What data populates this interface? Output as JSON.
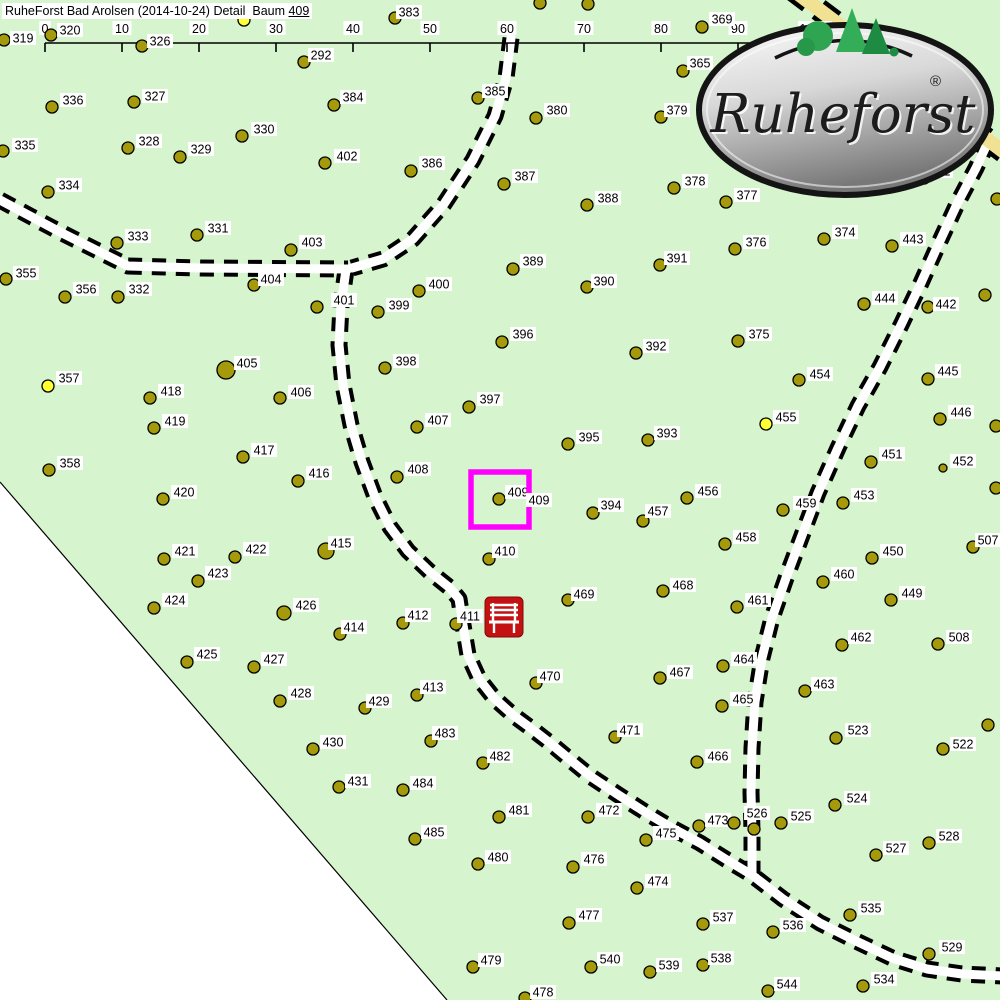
{
  "title": {
    "main": "RuheForst Bad Arolsen (2014-10-24) Detail  Baum ",
    "highlight": "409"
  },
  "scale_bar": {
    "labels": [
      "0",
      "10",
      "20",
      "30",
      "40",
      "50",
      "60",
      "70",
      "80",
      "90",
      "100m"
    ],
    "x0": 45,
    "step": 77,
    "y": 43
  },
  "logo": {
    "text": "Ruheforst",
    "registered": "®"
  },
  "map": {
    "colors": {
      "map_bg": "#d6f5cf",
      "outside": "#ffffff",
      "tree_fill": "#a49a0c",
      "tree_stroke": "#000000",
      "yellow_tree": "#ffff33",
      "road_fill": "#ffffff",
      "road_casing": "#000000",
      "yellow_road": "#f0e193",
      "highlight": "#ff00ff",
      "bench_red": "#c41111",
      "label_bg": "#ffffff",
      "label_text": "#000000",
      "boundary": "#000000"
    },
    "boundary_polygon": [
      [
        0,
        482
      ],
      [
        447,
        1000
      ],
      [
        0,
        1000
      ]
    ],
    "roads": [
      {
        "name": "road-west",
        "points": [
          [
            0,
            200
          ],
          [
            60,
            232
          ],
          [
            112,
            258
          ],
          [
            128,
            266
          ],
          [
            200,
            268
          ],
          [
            348,
            269
          ]
        ],
        "w": 9,
        "kind": "white"
      },
      {
        "name": "road-north-curve",
        "points": [
          [
            511,
            38
          ],
          [
            506,
            78
          ],
          [
            495,
            116
          ],
          [
            473,
            160
          ],
          [
            444,
            204
          ],
          [
            413,
            239
          ],
          [
            383,
            259
          ],
          [
            352,
            268
          ]
        ],
        "w": 9,
        "kind": "white"
      },
      {
        "name": "road-main-south",
        "points": [
          [
            346,
            270
          ],
          [
            341,
            305
          ],
          [
            339,
            345
          ],
          [
            343,
            385
          ],
          [
            351,
            425
          ],
          [
            362,
            462
          ],
          [
            375,
            497
          ],
          [
            390,
            527
          ],
          [
            408,
            551
          ],
          [
            430,
            572
          ],
          [
            450,
            588
          ],
          [
            459,
            599
          ],
          [
            463,
            625
          ],
          [
            468,
            655
          ],
          [
            479,
            679
          ],
          [
            494,
            698
          ],
          [
            513,
            715
          ],
          [
            532,
            729
          ],
          [
            550,
            743
          ],
          [
            568,
            758
          ],
          [
            590,
            776
          ],
          [
            617,
            794
          ],
          [
            645,
            812
          ],
          [
            672,
            828
          ],
          [
            700,
            843
          ],
          [
            727,
            860
          ],
          [
            752,
            875
          ],
          [
            783,
            899
          ],
          [
            820,
            923
          ],
          [
            856,
            941
          ],
          [
            892,
            958
          ],
          [
            927,
            969
          ],
          [
            962,
            974
          ],
          [
            1002,
            976
          ]
        ],
        "w": 9,
        "kind": "white"
      },
      {
        "name": "road-east",
        "points": [
          [
            988,
            142
          ],
          [
            976,
            168
          ],
          [
            958,
            202
          ],
          [
            939,
            243
          ],
          [
            921,
            283
          ],
          [
            901,
            325
          ],
          [
            880,
            367
          ],
          [
            858,
            406
          ],
          [
            838,
            448
          ],
          [
            818,
            493
          ],
          [
            801,
            538
          ],
          [
            786,
            578
          ],
          [
            772,
            618
          ],
          [
            762,
            658
          ],
          [
            755,
            702
          ],
          [
            752,
            748
          ],
          [
            751,
            792
          ],
          [
            752,
            832
          ],
          [
            752,
            874
          ]
        ],
        "w": 9,
        "kind": "white"
      },
      {
        "name": "road-yellow-corner",
        "points": [
          [
            793,
            -10
          ],
          [
            870,
            48
          ],
          [
            935,
            100
          ],
          [
            1004,
            152
          ]
        ],
        "w": 14,
        "kind": "yellow"
      }
    ],
    "trees": [
      [
        "319",
        4,
        40,
        23,
        38
      ],
      [
        "320",
        51,
        35,
        70,
        30
      ],
      [
        "326",
        142,
        46,
        160,
        41
      ],
      [
        "383",
        395,
        18,
        409,
        12
      ],
      [
        "292",
        304,
        62,
        321,
        55
      ],
      [
        "336",
        52,
        107,
        73,
        100
      ],
      [
        "327",
        134,
        102,
        155,
        96
      ],
      [
        "328",
        128,
        148,
        149,
        141
      ],
      [
        "329",
        180,
        157,
        201,
        149
      ],
      [
        "330",
        242,
        136,
        264,
        129
      ],
      [
        "335",
        3,
        151,
        25,
        145
      ],
      [
        "334",
        48,
        192,
        69,
        185
      ],
      [
        "333",
        117,
        243,
        138,
        236
      ],
      [
        "331",
        197,
        235,
        218,
        228
      ],
      [
        "355",
        6,
        279,
        26,
        273
      ],
      [
        "356",
        65,
        297,
        86,
        289
      ],
      [
        "332",
        118,
        297,
        139,
        289
      ],
      [
        "357",
        48,
        386,
        69,
        378
      ],
      [
        "358",
        49,
        470,
        70,
        463
      ],
      [
        "384",
        334,
        105,
        353,
        97
      ],
      [
        "385",
        478,
        98,
        495,
        91
      ],
      [
        "380",
        536,
        118,
        557,
        110
      ],
      [
        "379",
        661,
        117,
        677,
        110
      ],
      [
        "369",
        702,
        27,
        722,
        19
      ],
      [
        "365",
        683,
        71,
        700,
        63
      ],
      [
        "352",
        924,
        178,
        940,
        171
      ],
      [
        "402",
        325,
        163,
        347,
        156
      ],
      [
        "386",
        411,
        171,
        432,
        163
      ],
      [
        "387",
        504,
        184,
        525,
        176
      ],
      [
        "388",
        587,
        205,
        608,
        198
      ],
      [
        "378",
        674,
        188,
        695,
        181
      ],
      [
        "377",
        726,
        202,
        747,
        195
      ],
      [
        "376",
        735,
        249,
        756,
        242
      ],
      [
        "374",
        824,
        239,
        845,
        232
      ],
      [
        "443",
        892,
        246,
        913,
        239
      ],
      [
        "403",
        291,
        250,
        312,
        242
      ],
      [
        "404",
        254,
        285,
        271,
        279
      ],
      [
        "389",
        513,
        269,
        533,
        261
      ],
      [
        "390",
        587,
        287,
        604,
        281
      ],
      [
        "391",
        660,
        265,
        677,
        258
      ],
      [
        "400",
        419,
        291,
        439,
        284
      ],
      [
        "399",
        378,
        312,
        399,
        305
      ],
      [
        "401",
        317,
        307,
        344,
        300
      ],
      [
        "442",
        928,
        307,
        946,
        304
      ],
      [
        "444",
        864,
        304,
        885,
        298
      ],
      [
        "445",
        928,
        379,
        948,
        371
      ],
      [
        "446",
        940,
        419,
        961,
        412
      ],
      [
        "444",
        864,
        304,
        885,
        298
      ],
      [
        "375",
        738,
        341,
        759,
        334
      ],
      [
        "454",
        799,
        380,
        820,
        374
      ],
      [
        "455",
        766,
        424,
        786,
        417
      ],
      [
        "405",
        226,
        370,
        247,
        363
      ],
      [
        "418",
        150,
        398,
        171,
        391
      ],
      [
        "406",
        280,
        398,
        301,
        392
      ],
      [
        "396",
        502,
        342,
        523,
        334
      ],
      [
        "392",
        636,
        353,
        656,
        346
      ],
      [
        "398",
        385,
        368,
        406,
        361
      ],
      [
        "397",
        469,
        407,
        490,
        399
      ],
      [
        "407",
        417,
        427,
        438,
        420
      ],
      [
        "393",
        648,
        440,
        667,
        433
      ],
      [
        "395",
        568,
        444,
        589,
        437
      ],
      [
        "419",
        154,
        428,
        175,
        421
      ],
      [
        "417",
        243,
        457,
        264,
        450
      ],
      [
        "416",
        298,
        481,
        319,
        473
      ],
      [
        "420",
        163,
        499,
        184,
        492
      ],
      [
        "451",
        871,
        462,
        892,
        454
      ],
      [
        "452",
        943,
        468,
        963,
        461
      ],
      [
        "453",
        843,
        503,
        864,
        495
      ],
      [
        "456",
        687,
        498,
        708,
        491
      ],
      [
        "457",
        643,
        521,
        658,
        511
      ],
      [
        "459",
        783,
        510,
        806,
        503
      ],
      [
        "458",
        725,
        544,
        746,
        537
      ],
      [
        "507",
        973,
        547,
        988,
        540
      ],
      [
        "450",
        872,
        558,
        893,
        551
      ],
      [
        "460",
        823,
        582,
        844,
        574
      ],
      [
        "449",
        891,
        600,
        912,
        593
      ],
      [
        "468",
        663,
        591,
        683,
        585
      ],
      [
        "461",
        737,
        607,
        758,
        600
      ],
      [
        "409",
        499,
        499,
        518,
        492
      ],
      [
        "394",
        593,
        513,
        611,
        505
      ],
      [
        "408",
        397,
        477,
        418,
        469
      ],
      [
        "421",
        164,
        559,
        185,
        551
      ],
      [
        "422",
        235,
        557,
        256,
        549
      ],
      [
        "415",
        326,
        551,
        341,
        543
      ],
      [
        "410",
        489,
        559,
        505,
        551
      ],
      [
        "423",
        198,
        581,
        218,
        573
      ],
      [
        "424",
        154,
        608,
        175,
        600
      ],
      [
        "426",
        284,
        613,
        306,
        605
      ],
      [
        "469",
        568,
        600,
        584,
        594
      ],
      [
        "412",
        403,
        623,
        418,
        615
      ],
      [
        "414",
        340,
        634,
        354,
        627
      ],
      [
        "411",
        456,
        624,
        470,
        616
      ],
      [
        "425",
        187,
        662,
        207,
        654
      ],
      [
        "427",
        254,
        667,
        274,
        659
      ],
      [
        "470",
        536,
        683,
        550,
        676
      ],
      [
        "467",
        660,
        678,
        680,
        672
      ],
      [
        "464",
        723,
        666,
        744,
        659
      ],
      [
        "462",
        842,
        645,
        861,
        637
      ],
      [
        "508",
        938,
        644,
        959,
        637
      ],
      [
        "463",
        805,
        691,
        824,
        684
      ],
      [
        "465",
        722,
        706,
        743,
        699
      ],
      [
        "428",
        280,
        701,
        301,
        693
      ],
      [
        "413",
        417,
        695,
        433,
        687
      ],
      [
        "429",
        365,
        708,
        379,
        701
      ],
      [
        "523",
        836,
        738,
        858,
        730
      ],
      [
        "522",
        943,
        749,
        963,
        744
      ],
      [
        "466",
        697,
        762,
        718,
        756
      ],
      [
        "430",
        313,
        749,
        333,
        742
      ],
      [
        "483",
        431,
        741,
        445,
        733
      ],
      [
        "471",
        615,
        737,
        630,
        730
      ],
      [
        "472",
        588,
        817,
        609,
        810
      ],
      [
        "481",
        499,
        817,
        519,
        810
      ],
      [
        "473",
        699,
        826,
        718,
        820
      ],
      [
        "526",
        754,
        829,
        757,
        813
      ],
      [
        "525",
        781,
        823,
        801,
        816
      ],
      [
        "475",
        646,
        840,
        666,
        833
      ],
      [
        "524",
        835,
        805,
        857,
        798
      ],
      [
        "527",
        876,
        855,
        896,
        848
      ],
      [
        "528",
        929,
        843,
        949,
        836
      ],
      [
        "431",
        339,
        787,
        358,
        781
      ],
      [
        "484",
        403,
        790,
        423,
        783
      ],
      [
        "482",
        483,
        763,
        500,
        756
      ],
      [
        "480",
        478,
        864,
        498,
        857
      ],
      [
        "476",
        573,
        867,
        594,
        859
      ],
      [
        "474",
        637,
        888,
        658,
        881
      ],
      [
        "485",
        415,
        839,
        434,
        832
      ],
      [
        "477",
        569,
        923,
        589,
        915
      ],
      [
        "537",
        703,
        924,
        723,
        917
      ],
      [
        "535",
        850,
        915,
        871,
        908
      ],
      [
        "536",
        773,
        932,
        793,
        925
      ],
      [
        "529",
        929,
        954,
        952,
        947
      ],
      [
        "538",
        703,
        965,
        721,
        958
      ],
      [
        "544",
        768,
        991,
        787,
        984
      ],
      [
        "534",
        863,
        986,
        884,
        979
      ],
      [
        "479",
        473,
        967,
        491,
        960
      ],
      [
        "540",
        591,
        967,
        610,
        959
      ],
      [
        "539",
        650,
        972,
        669,
        965
      ],
      [
        "478",
        525,
        998,
        543,
        992
      ]
    ],
    "special_radius": {
      "405": 9,
      "415": 8,
      "426": 7,
      "452": 4
    },
    "yellow_trees": [
      "357",
      "455"
    ],
    "unlabeled_trees": [
      [
        540,
        3
      ],
      [
        588,
        4
      ],
      [
        997,
        199
      ],
      [
        985,
        295
      ],
      [
        996,
        426
      ],
      [
        996,
        488
      ],
      [
        988,
        725
      ],
      [
        734,
        823
      ]
    ],
    "unlabeled_yellow": [
      [
        244,
        20
      ]
    ],
    "highlight_square": {
      "x": 471,
      "y": 472,
      "w": 58,
      "h": 55
    },
    "extra_label": {
      "text": "409",
      "x": 539,
      "y": 500
    },
    "bench": {
      "x": 485,
      "y": 597,
      "w": 38,
      "h": 40
    }
  }
}
